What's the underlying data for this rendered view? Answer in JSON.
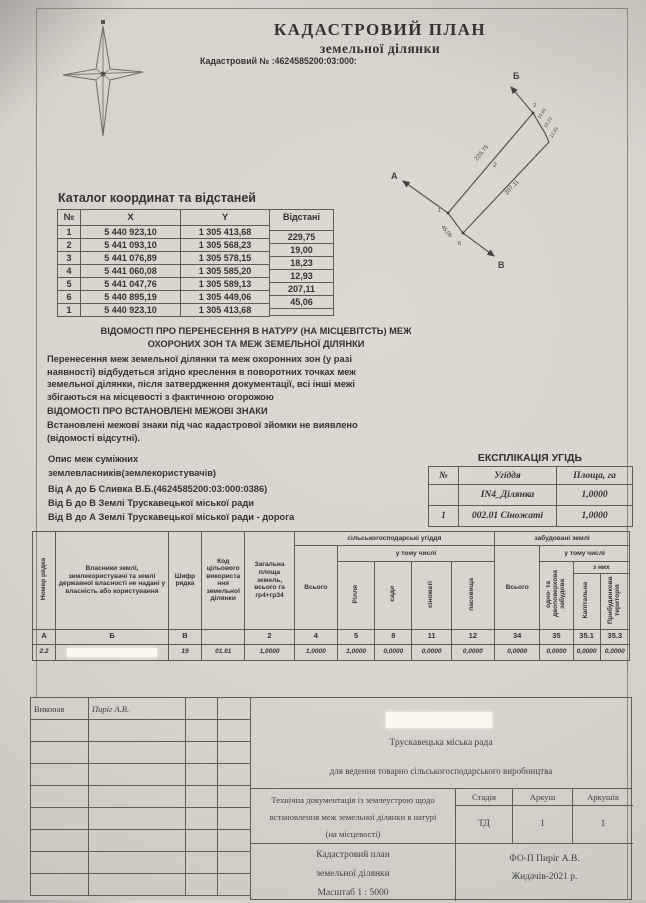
{
  "page": {
    "title1": "КАДАСТРОВИЙ ПЛАН",
    "title2": "земельної ділянки",
    "cad_number": "Кадастровий №  :4624585200:03:000:"
  },
  "diagram": {
    "north_icon": "compass-star",
    "pt_a": "А",
    "pt_b": "Б",
    "pt_v": "В",
    "v1": "1",
    "v2": "2",
    "v6": "6",
    "parcel_no": "2",
    "edge_12": "229,75",
    "edge_56": "207,11",
    "edge_16": "45,06",
    "edge_23": "19,00",
    "edge_34": "18,23",
    "edge_45": "12,93"
  },
  "coords_table": {
    "title": "Каталог координат та відстаней",
    "headers": [
      "№",
      "X",
      "Y",
      "Відстані"
    ],
    "rows": [
      {
        "n": "1",
        "x": "5 440 923,10",
        "y": "1 305 413,68"
      },
      {
        "n": "2",
        "x": "5 441 093,10",
        "y": "1 305 568,23"
      },
      {
        "n": "3",
        "x": "5 441 076,89",
        "y": "1 305 578,15"
      },
      {
        "n": "4",
        "x": "5 441 060,08",
        "y": "1 305 585,20"
      },
      {
        "n": "5",
        "x": "5 441 047,76",
        "y": "1 305 589,13"
      },
      {
        "n": "6",
        "x": "5 440 895,19",
        "y": "1 305 449,06"
      },
      {
        "n": "1",
        "x": "5 440 923,10",
        "y": "1 305 413,68"
      }
    ],
    "distances": [
      "229,75",
      "19,00",
      "18,23",
      "12,93",
      "207,11",
      "45,06"
    ]
  },
  "sections": {
    "transfer_title": "ВІДОМОСТІ ПРО ПЕРЕНЕСЕННЯ В НАТУРУ (НА МІСЦЕВІТСТЬ) МЕЖ\nОХОРОНИХ ЗОН  ТА МЕЖ ЗЕМЕЛЬНОЇ ДІЛЯНКИ",
    "transfer_body": "Перенесення меж земельної ділянки та меж охоронних зон (у разі\nнаявності) відбудеться згідно креслення в поворотних точках меж\nземельної ділянки, після затвердження документації, всі інші межі\nзбігаються на місцевості з фактичною огорожою",
    "marks_title": "ВІДОМОСТІ ПРО ВСТАНОВЛЕНІ МЕЖОВІ ЗНАКИ",
    "marks_body": "Встановлені межові знаки під час кадастрової зйомки не виявлено\n(відомості відсутні).",
    "neighbors_title": "Опис меж суміжних\nземлевласників(землекористувачів)",
    "neighbors": [
      "Від А до Б   Сливка В.Б.(4624585200:03:000:0386)",
      "Від Б до В   Землі Трускавецької міської ради",
      "Від В до А   Землі Трускавецької міської ради - дорога"
    ]
  },
  "explication": {
    "title": "ЕКСПЛІКАЦІЯ УГІДЬ",
    "headers": [
      "№",
      "Угіддя",
      "Площа, га"
    ],
    "rows": [
      [
        "",
        "IN4_Ділянка",
        "1,0000"
      ],
      [
        "1",
        "002.01 Сіножаті",
        "1,0000"
      ]
    ]
  },
  "landform": {
    "col_row_num": "Номер рядка",
    "col_owners": "Власники землі, землекористувачі та землі державної власності не надані у власність або користування",
    "col_code": "Шифр рядка",
    "col_purpose": "Код цільового використа ння земельної ділянки",
    "col_total_area": "Загальна площа земель, всього га гр4+гр34",
    "agri_group": "сільськогосподарські угіддя",
    "built_group": "забудовані землі",
    "incl": "у тому числі",
    "total": "Всього",
    "of_which": "з них",
    "agri_cols": [
      "Рілля",
      "сади",
      "сіножаті",
      "пасовища"
    ],
    "built_col1": "одно- та двоповерхова забудова",
    "built_sub": [
      "Капітальна",
      "Прибудинкова територія"
    ],
    "letters": [
      "А",
      "Б",
      "В",
      "",
      "2",
      "4",
      "5",
      "8",
      "11",
      "12",
      "34",
      "35",
      "35.1",
      "35.3"
    ],
    "values": [
      "2.2",
      "",
      "19",
      "01.01",
      "1,0000",
      "1,0000",
      "1,0000",
      "0,0000",
      "0,0000",
      "0,0000",
      "0,0000",
      "0,0000",
      "0,0000",
      "0,0000"
    ]
  },
  "stamp": {
    "executor_label": "Виконав",
    "executor_name": "Пиріг А.В.",
    "council": "Трускавецька міська рада",
    "purpose": "для ведення товарно сільськогосподарського виробництва",
    "doc_lines": "Технічна документація із землеустрою  щодо\nвстановлення меж земельної ділянки в натурі\n(на місцевості)",
    "stage_label": "Стадія",
    "sheet_label": "Аркуш",
    "sheets_label": "Аркушів",
    "stage": "ТД",
    "sheet": "1",
    "sheets": "1",
    "plan_lines": "Кадастровий план\nземельної ділянки",
    "scale": "Масштаб 1 :   5000",
    "author": "ФО-П Пиріг А.В.",
    "place_year": "Жидачів-2021 р."
  }
}
